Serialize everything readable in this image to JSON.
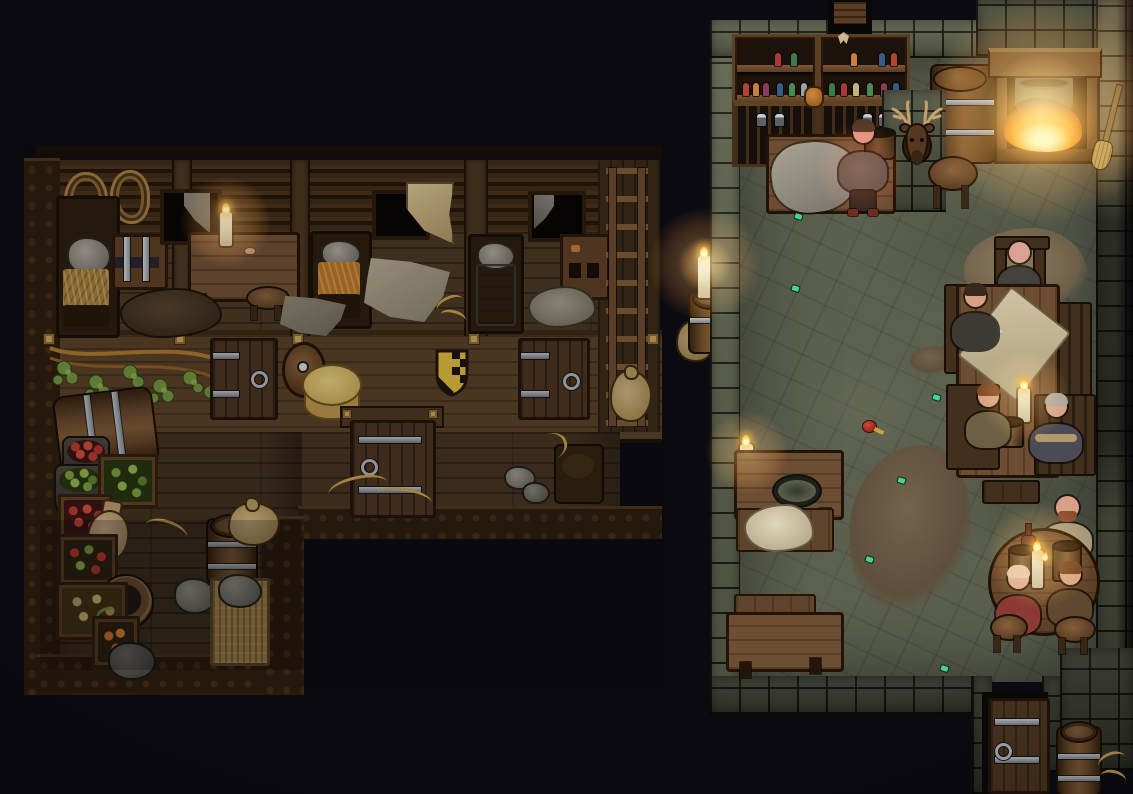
{
  "meta": {
    "scene_title": "Tavern and Inn — Night Interior",
    "style": "top-down pixel-art RPG scene",
    "setting": "A stone-floored tavern common room on the right, joined to a timber inn wing with guest bedrooms, a hallway of doors and a storage room on the left",
    "lighting": "Night; lit only by a cauldron fireplace and scattered candles"
  },
  "palette": {
    "background": "#0b0a11",
    "inn_wood_floor": "#4b3722",
    "inn_log_wall": "#31210f",
    "inn_plank_wall": "#573f26",
    "door_wood": "#49331e",
    "stone_floor": "#5c614f",
    "stone_wall": "#60654f",
    "table_wood": "#6e4e33",
    "fire_orange": "#ff8f1e",
    "candle_flame": "#ffd23e",
    "straw": "#9c7c3c",
    "cheese": "#d9c071",
    "fur": "#e0d6bb",
    "coin_green": "#45d392",
    "skin": "#d9a183"
  },
  "areas": [
    {
      "id": "inn-bedrooms",
      "name": "Inn bedrooms",
      "description": "Row of small rooms: straw beds with stone pillows, a banded chest, a table with a candle, windows with torn curtains"
    },
    {
      "id": "inn-hallway",
      "name": "Inn hallway",
      "description": "Plank wall with guest-room doors, a round wooden shield, a yellow-and-black heraldic shield and a large cheese wheel"
    },
    {
      "id": "inn-storage",
      "name": "Storage room",
      "description": "Crates of vegetables and fruit, pots, a clay jug, sacks, barrels, a bucket and a straw sleeping mat"
    },
    {
      "id": "tavern-hall",
      "name": "Tavern common room",
      "description": "Stone hall with bottle shelves, bar counter, mounted deer head, long table and round table full of patrons"
    },
    {
      "id": "fireplace-nook",
      "name": "Fireplace nook",
      "description": "Stone hearth with a cauldron over a burning fire; a broom leans on the wall"
    },
    {
      "id": "south-entrance",
      "name": "South entrance",
      "description": "Banded wooden door in the south stone wall with a barrel beside it"
    }
  ],
  "characters": [
    {
      "id": "innkeeper",
      "role": "Tavern keeper",
      "hair": "grey-brown, bearded",
      "hair_color": "#533829",
      "outfit": "grey-green vest, dark trousers, red-brown boots",
      "outfit_color": "#59514a",
      "skin_color": "#e2907c",
      "location": "beside the bar counter",
      "activity": "standing, face lit by firelight",
      "tooltip": "Tavern keeper standing by the bar counter"
    },
    {
      "id": "patron-bald",
      "role": "Patron",
      "hair": "bald",
      "hair_color": "",
      "outfit": "dark grey tunic",
      "outfit_color": "#45413d",
      "skin_color": "#dba192",
      "location": "head of the long table",
      "activity": "seated in a high-backed chair",
      "tooltip": "Bald patron at the head of the long table"
    },
    {
      "id": "patron-dark-hair",
      "role": "Patron",
      "hair": "dark brown",
      "hair_color": "#39291c",
      "outfit": "dark tunic",
      "outfit_color": "#3d3a36",
      "skin_color": "#d9a183",
      "location": "west side of the long table",
      "activity": "seated, a knife lying on the table",
      "tooltip": "Dark-haired patron on the west side of the long table"
    },
    {
      "id": "patron-brown-hair",
      "role": "Patron",
      "hair": "brown",
      "hair_color": "#7c4a28",
      "outfit": "olive-tan tunic",
      "outfit_color": "#6d5f45",
      "skin_color": "#d9a183",
      "location": "south-west seat of the long table",
      "activity": "seated with a mug of ale",
      "tooltip": "Patron drinking at the long table"
    },
    {
      "id": "patron-grey-hair",
      "role": "Elderly patron",
      "hair": "grey",
      "hair_color": "#a9a59b",
      "outfit": "blue-grey coat with tan collar",
      "outfit_color": "#4b4b55",
      "skin_color": "#d3a08a",
      "location": "south-east seat of the long table",
      "activity": "seated",
      "tooltip": "Grey-haired patron at the long table"
    },
    {
      "id": "patron-bearded",
      "role": "Patron",
      "hair": "bald with red-brown beard",
      "hair_color": "#8c4c30",
      "outfit": "tan tunic with shoulder bag",
      "outfit_color": "#a5977a",
      "skin_color": "#d8a088",
      "location": "north side of the round table",
      "activity": "seated",
      "tooltip": "Bearded patron at the round table"
    },
    {
      "id": "patron-fair-hair",
      "role": "Patron",
      "hair": "light strawberry-blond",
      "hair_color": "#e7c3a4",
      "outfit": "maroon tunic",
      "outfit_color": "#8a3a32",
      "skin_color": "#e0ab93",
      "location": "south-west stool of the round table",
      "activity": "seated",
      "tooltip": "Fair-haired patron at the round table"
    },
    {
      "id": "patron-auburn",
      "role": "Patron",
      "hair": "auburn brown",
      "hair_color": "#6b3f24",
      "outfit": "brown tunic",
      "outfit_color": "#60492f",
      "skin_color": "#d9a183",
      "location": "east seat of the round table",
      "activity": "seated",
      "tooltip": "Auburn-haired patron at the round table"
    }
  ],
  "props": {
    "deer_head": {
      "label": "Mounted deer head trophy"
    },
    "bottle_shelves": {
      "label": "Wall shelf with bottles"
    },
    "liquor_cabinet": {
      "label": "Lower cabinet with jars"
    },
    "orange_jug": {
      "label": "Small orange jug"
    },
    "moth": {
      "label": "Moth on the wall"
    },
    "big_barrel": {
      "label": "Large ale barrel"
    },
    "fireplace": {
      "label": "Stone fireplace"
    },
    "cauldron": {
      "label": "Cauldron over the fire"
    },
    "broom": {
      "label": "Broom leaning on the wall"
    },
    "bar_counter": {
      "label": "Bar counter"
    },
    "counter_cloth": {
      "label": "Grey cloth on the counter"
    },
    "serving_bucket": {
      "label": "Serving bucket"
    },
    "bar_stool": {
      "label": "Bar stool"
    },
    "north_doorway": {
      "label": "North doorway"
    },
    "high_chair": {
      "label": "High-backed chair"
    },
    "chair": {
      "label": "Wooden chair"
    },
    "long_table": {
      "label": "Long table"
    },
    "table_map": {
      "label": "Map spread on the table"
    },
    "table_knife": {
      "label": "Knife on the table"
    },
    "table_candle": {
      "label": "Lit candle"
    },
    "table_mug": {
      "label": "Mug of ale"
    },
    "round_table": {
      "label": "Round table"
    },
    "wine_bottle": {
      "label": "Bottle of wine"
    },
    "round_mug": {
      "label": "Wooden mug"
    },
    "bench": {
      "label": "Wooden bench"
    },
    "side_table_north": {
      "label": "Side table with a dish"
    },
    "food_dish": {
      "label": "Serving dish"
    },
    "fur_bench": {
      "label": "Bench draped with fur"
    },
    "side_table_south": {
      "label": "Side table"
    },
    "south_door": {
      "label": "South entrance door"
    },
    "entry_barrel": {
      "label": "Barrel by the entrance"
    },
    "dirt_patch": {
      "label": "Patch of dirt on the stone floor"
    },
    "floor_coins": {
      "label": "Scattered green coins",
      "count": 7
    },
    "dropped_apple": {
      "label": "Dropped apple"
    },
    "wall_candle": {
      "label": "Candle on a wall bracket"
    },
    "round_stool": {
      "label": "Stool"
    },
    "bed_straw": {
      "label": "Bed with straw and stone pillow"
    },
    "bed_orange": {
      "label": "Bed with orange straw bedding"
    },
    "bed_grey": {
      "label": "Bed with a grey blanket"
    },
    "chest": {
      "label": "Banded storage chest"
    },
    "inn_table": {
      "label": "Bedroom table"
    },
    "inn_candle": {
      "label": "Candle on the table"
    },
    "inn_stool": {
      "label": "Stool"
    },
    "inn_mouse": {
      "label": "Mouse on the table"
    },
    "window": {
      "label": "Window with torn curtain"
    },
    "curtain_flap": {
      "label": "Hanging cloth flap"
    },
    "tarp": {
      "label": "Torn grey tarp"
    },
    "cloth_pile": {
      "label": "Pile of cloth"
    },
    "guest_door": {
      "label": "Guest room door"
    },
    "middle_door": {
      "label": "Hallway door"
    },
    "round_shield": {
      "label": "Round wooden shield"
    },
    "heraldic_shield": {
      "label": "Yellow-and-black heraldic shield"
    },
    "cheese_wheel": {
      "label": "Cheese wheel"
    },
    "hops_vine": {
      "label": "Hop vine hanging on the wall"
    },
    "ladder": {
      "label": "Ladder against the east wall"
    },
    "sack": {
      "label": "Burlap sack"
    },
    "candle_barrel": {
      "label": "Candle on a barrel"
    },
    "side_barrel": {
      "label": "Barrel lying on its side"
    },
    "pot_red": {
      "label": "Pot of red berries"
    },
    "pot_green": {
      "label": "Pot of greens"
    },
    "crate_greens": {
      "label": "Crate of greens"
    },
    "crate_red": {
      "label": "Crate of tomatoes"
    },
    "crate_strawberries": {
      "label": "Crate of strawberries"
    },
    "crate_potatoes": {
      "label": "Crate of potatoes"
    },
    "crate_carrots": {
      "label": "Crate of carrots"
    },
    "clay_jug": {
      "label": "Clay jug"
    },
    "storage_barrel": {
      "label": "Storage barrel"
    },
    "bucket": {
      "label": "Wooden bucket"
    },
    "straw_mat": {
      "label": "Straw sleeping mat"
    },
    "stones": {
      "label": "Loose stones"
    },
    "rope_coils": {
      "label": "Coiled ropes on the wall"
    },
    "steps": {
      "label": "Wooden steps"
    }
  },
  "lighting_sources": [
    {
      "id": "fireplace-fire",
      "type": "fire",
      "location": "north-east hearth"
    },
    {
      "id": "candle-inn-table",
      "type": "candle",
      "location": "inn bedroom table"
    },
    {
      "id": "candle-gap-barrel",
      "type": "candle",
      "location": "barrel at the inn's east wall"
    },
    {
      "id": "candle-tavern-wall",
      "type": "candle",
      "location": "tavern west wall"
    },
    {
      "id": "candle-long-table",
      "type": "candle",
      "location": "long table"
    },
    {
      "id": "candles-round-table",
      "type": "candle",
      "location": "round table"
    }
  ]
}
